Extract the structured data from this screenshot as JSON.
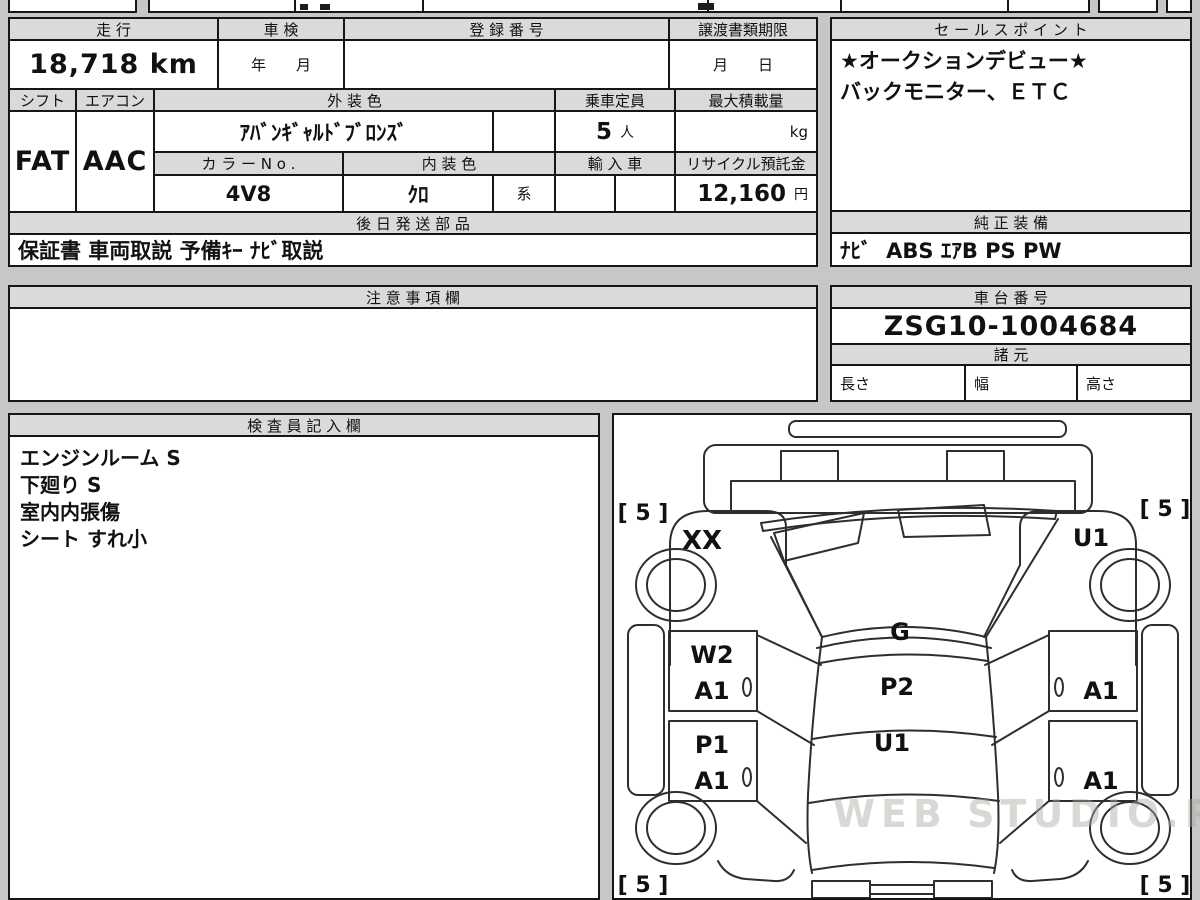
{
  "page": {
    "watermark": "WEB STUDIO.RU"
  },
  "vehicle_table": {
    "mileage": {
      "label": "走 行",
      "value": "18,718 km"
    },
    "shaken": {
      "label": "車 検",
      "value": "年　　月"
    },
    "registration": {
      "label": "登 録 番 号",
      "value": ""
    },
    "transfer_deadline": {
      "label": "譲渡書類期限",
      "value": "月　　日"
    },
    "shift": {
      "label": "シフト",
      "value": "FAT"
    },
    "aircon": {
      "label": "エアコン",
      "value": "AAC"
    },
    "exterior_color": {
      "label": "外 装 色",
      "value": "ｱﾊﾞﾝｷﾞｬﾙﾄﾞﾌﾞﾛﾝｽﾞ"
    },
    "capacity": {
      "label": "乗車定員",
      "value": "5",
      "unit": "人"
    },
    "max_load": {
      "label": "最大積載量",
      "value": "",
      "unit": "kg"
    },
    "color_no": {
      "label": "カ ラ ー N o .",
      "value": "4V8"
    },
    "interior_color": {
      "label": "内 装 色",
      "value": "ｸﾛ",
      "suffix": "系"
    },
    "import_car": {
      "label": "輸 入 車",
      "value": ""
    },
    "recycle_deposit": {
      "label": "リサイクル預託金",
      "value": "12,160",
      "unit": "円"
    },
    "later_shipped_parts": {
      "label": "後 日 発 送 部 品",
      "value": "保証書 車両取説 予備ｷｰ ﾅﾋﾞ取説"
    }
  },
  "sales_point": {
    "label": "セ ー ル ス ポ イ ン ト",
    "line1": "★オークションデビュー★",
    "line2": "バックモニター、ＥＴＣ"
  },
  "genuine_equipment": {
    "label": "純 正 装 備",
    "value": "ﾅﾋﾞ  ABS ｴｱB PS PW"
  },
  "notes": {
    "label": "注 意 事 項 欄",
    "value": ""
  },
  "chassis": {
    "label": "車 台 番 号",
    "value": "ZSG10-1004684",
    "specs_label": "諸 元",
    "length_label": "長さ",
    "width_label": "幅",
    "height_label": "高さ"
  },
  "inspector_notes": {
    "label": "検 査 員 記 入 欄",
    "lines": [
      "エンジンルーム S",
      "下廻り S",
      "室内内張傷",
      "シート すれ小"
    ]
  },
  "damage_diagram": {
    "tires": {
      "front_left": "[ 5 ]",
      "front_right": "[ 5 ]",
      "rear_left": "[ 5 ]",
      "rear_right": "[ 5 ]"
    },
    "codes": {
      "front_left_fender": "XX",
      "front_right_fender": "U1",
      "roof_front": "G",
      "left_front_door_upper": "W2",
      "left_front_door": "A1",
      "left_rear_door_upper": "P1",
      "left_rear_door": "A1",
      "roof_center": "P2",
      "roof_rear": "U1",
      "right_front_door": "A1",
      "right_rear_door": "A1"
    }
  }
}
